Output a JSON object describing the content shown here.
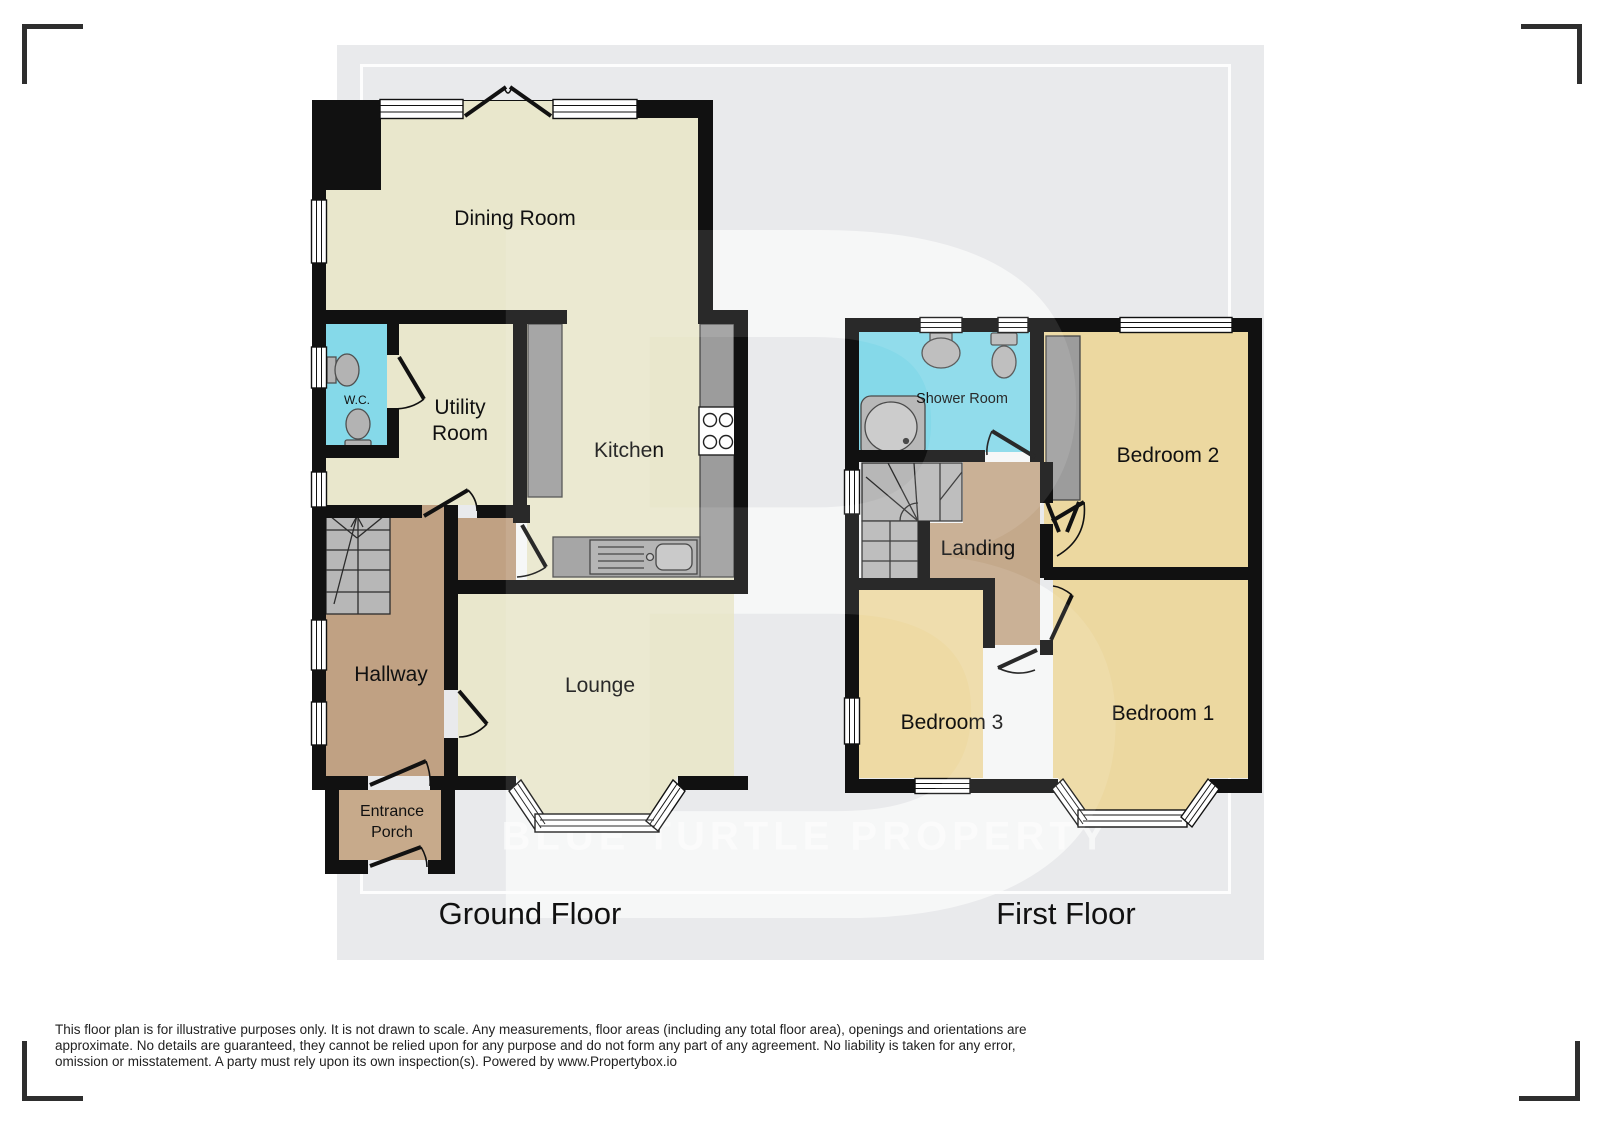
{
  "watermark": {
    "letter": "B",
    "text": "BLUE TURTLE PROPERTY"
  },
  "titles": {
    "ground": "Ground Floor",
    "first": "First Floor"
  },
  "rooms": {
    "ground": {
      "dining": "Dining Room",
      "wc": "W.C.",
      "utility_line1": "Utility",
      "utility_line2": "Room",
      "kitchen": "Kitchen",
      "hallway": "Hallway",
      "lounge": "Lounge",
      "porch_line1": "Entrance",
      "porch_line2": "Porch"
    },
    "first": {
      "shower": "Shower Room",
      "bedroom2": "Bedroom 2",
      "landing": "Landing",
      "bedroom3": "Bedroom 3",
      "bedroom1": "Bedroom 1"
    }
  },
  "disclaimer": {
    "line1": "This floor plan is for illustrative purposes only. It is not drawn to scale. Any measurements, floor areas (including any total floor area), openings and orientations are",
    "line2": "approximate. No details are guaranteed, they cannot be relied upon for any purpose and do not form any part of any agreement. No liability is taken for any error,",
    "line3": "omission or misstatement. A party must rely upon its own inspection(s). Powered by www.Propertybox.io"
  },
  "colors": {
    "wall": "#111111",
    "room_cream": "#e9e7cc",
    "room_cyan": "#85d9e9",
    "room_tan": "#c0a183",
    "room_tan_light": "#c7aa8b",
    "room_yellow": "#ecd8a0",
    "counter_gray": "#9c9c9c",
    "stair_gray": "#b7b7b7",
    "backdrop_gray": "#e9eaec"
  }
}
